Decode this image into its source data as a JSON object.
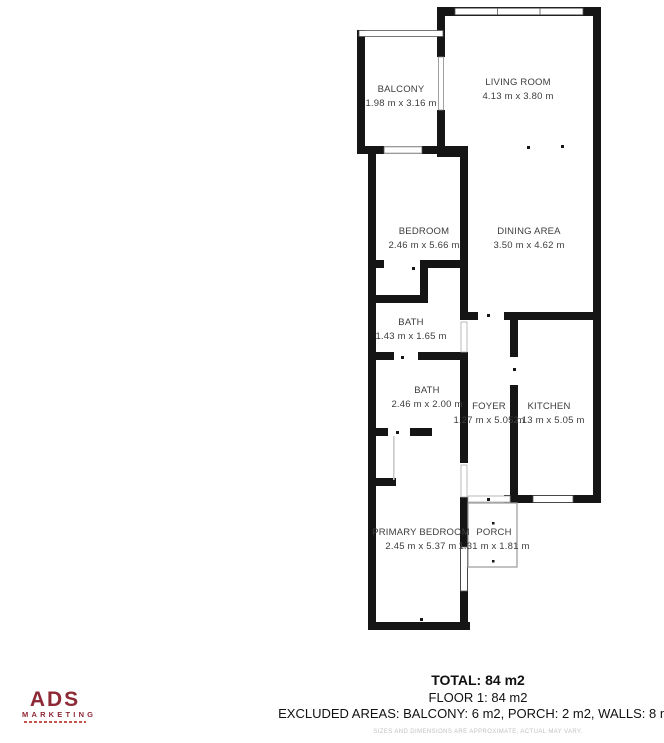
{
  "floor_plan": {
    "rooms": [
      {
        "name": "BALCONY",
        "dims": "1.98 m x 3.16 m"
      },
      {
        "name": "LIVING ROOM",
        "dims": "4.13 m x 3.80 m"
      },
      {
        "name": "BEDROOM",
        "dims": "2.46 m x 5.66 m"
      },
      {
        "name": "DINING AREA",
        "dims": "3.50 m x 4.62 m"
      },
      {
        "name": "BATH",
        "dims": "1.43 m x 1.65 m"
      },
      {
        "name": "BATH",
        "dims": "2.46 m x 2.00 m"
      },
      {
        "name": "FOYER",
        "dims": "1.27 m x 5.05 m"
      },
      {
        "name": "KITCHEN",
        "dims": "2.13 m x 5.05 m"
      },
      {
        "name": "PRIMARY BEDROOM",
        "dims": "2.45 m x 5.37 m"
      },
      {
        "name": "PORCH",
        "dims": "1.31 m x 1.81 m"
      }
    ]
  },
  "summary": {
    "total": "TOTAL: 84 m2",
    "floor": "FLOOR 1: 84 m2",
    "excluded": "EXCLUDED AREAS: BALCONY: 6 m2, PORCH: 2 m2, WALLS: 8 m2"
  },
  "disclaimer": "SIZES AND DIMENSIONS ARE APPROXIMATE, ACTUAL MAY VARY.",
  "logo": {
    "name": "ADS",
    "subtitle": "MARKETING"
  },
  "colors": {
    "wall": "#151515",
    "label_text": "#3d3d3d",
    "logo_red": "#8e2936",
    "disclaimer_gray": "#c2c2c2"
  }
}
